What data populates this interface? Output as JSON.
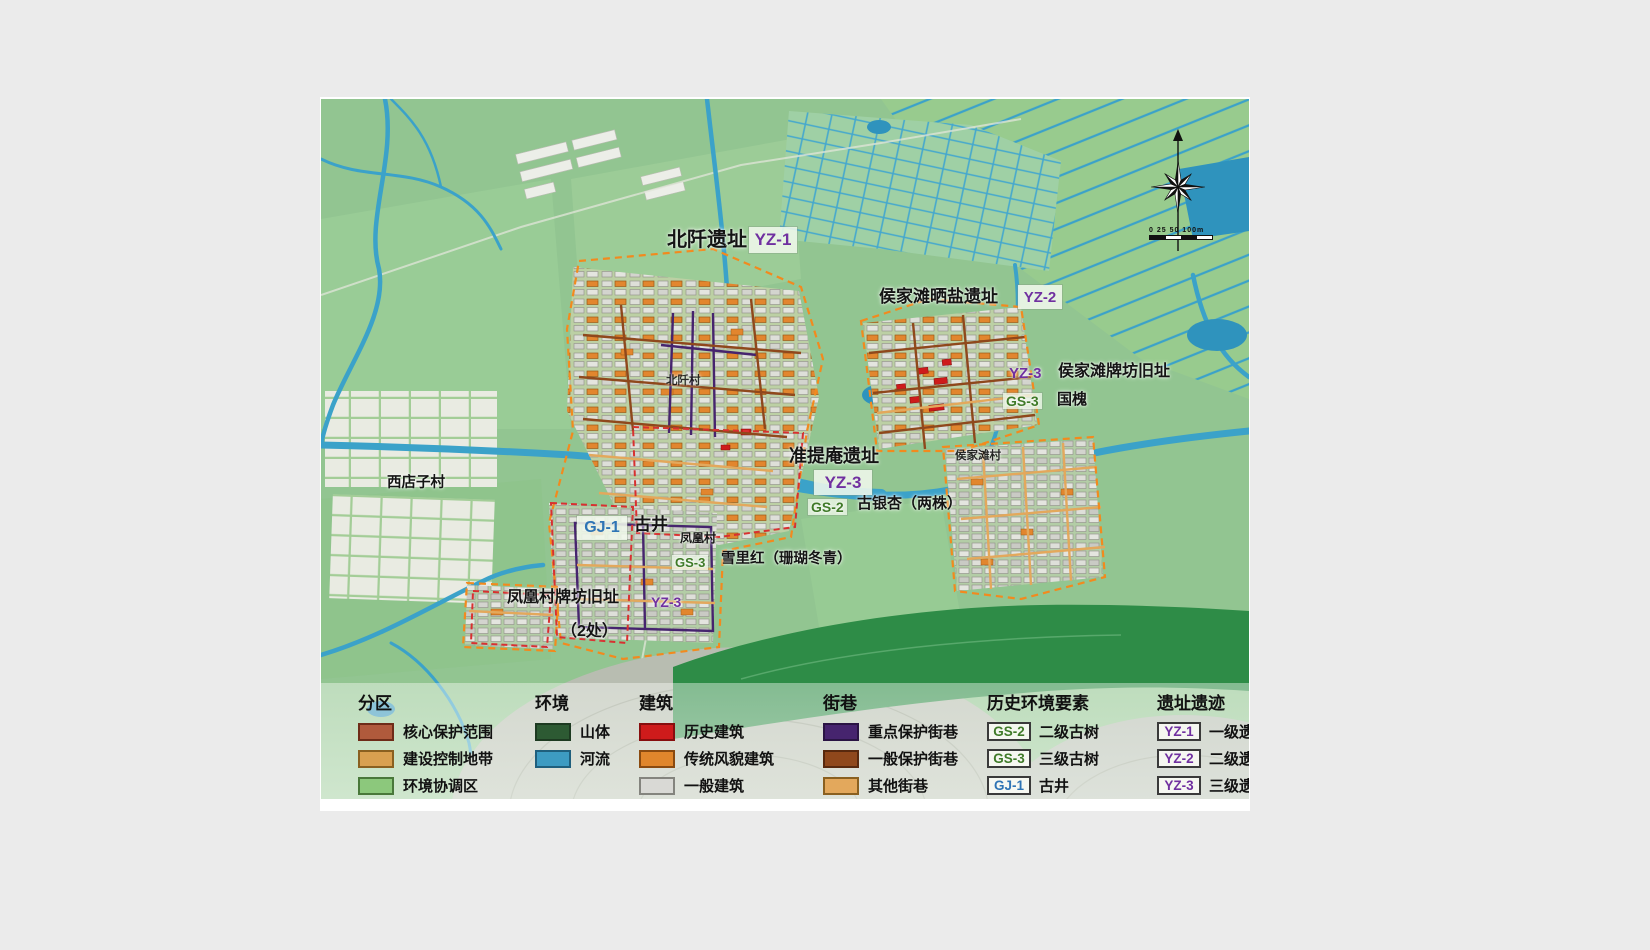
{
  "map_labels": {
    "beiqian_site": "北阡遗址",
    "beiqian_badge": "YZ-1",
    "houjiatan_salt_site": "侯家滩晒盐遗址",
    "houjiatan_salt_badge": "YZ-2",
    "houjiatan_paifang_badge": "YZ-3",
    "houjiatan_paifang_site": "侯家滩牌坊旧址",
    "houjiatan_tree_badge": "GS-3",
    "houjiatan_tree_label": "国槐",
    "zhuntian_site": "准提庵遗址",
    "zhuntian_badge": "YZ-3",
    "gingko_badge": "GS-2",
    "gingko_label": "古银杏（两株）",
    "well_badge": "GJ-1",
    "well_label": "古井",
    "xuelihong_badge": "GS-3",
    "xuelihong_label": "雪里红（珊瑚冬青）",
    "fenghuang_paifang_site": "凤凰村牌坊旧址",
    "fenghuang_paifang_badge": "YZ-3",
    "fenghuang_paifang_count": "（2处）",
    "village_xidianzi": "西店子村",
    "village_beiqian": "北阡村",
    "village_fenghuang": "凤凰村",
    "village_houjiatan": "侯家滩村",
    "scale_text": "0 25 50 100m"
  },
  "colors": {
    "yz_badge": "#7030a0",
    "gs_badge": "#3f7a28",
    "gj_badge": "#2e74b5",
    "river": "#3ba2c9",
    "base_green": "#92c591"
  },
  "legend": {
    "sections": [
      {
        "title": "分区",
        "items": [
          {
            "label": "核心保护范围",
            "swatch": "#b05a3c",
            "border": "#6e2c18"
          },
          {
            "label": "建设控制地带",
            "swatch": "#d9a050",
            "border": "#8a6020"
          },
          {
            "label": "环境协调区",
            "swatch": "#8cc87c",
            "border": "#49783a"
          }
        ]
      },
      {
        "title": "环境",
        "items": [
          {
            "label": "山体",
            "swatch": "#2d5a33",
            "border": "#1d3a21"
          },
          {
            "label": "河流",
            "swatch": "#3d9bc2",
            "border": "#1f5f7d"
          }
        ]
      },
      {
        "title": "建筑",
        "items": [
          {
            "label": "历史建筑",
            "swatch": "#ce1b1b",
            "border": "#870e0e"
          },
          {
            "label": "传统风貌建筑",
            "swatch": "#e0862c",
            "border": "#8a4a10"
          },
          {
            "label": "一般建筑",
            "swatch": "#d9d9d5",
            "border": "#84847e"
          }
        ]
      },
      {
        "title": "街巷",
        "items": [
          {
            "label": "重点保护街巷",
            "swatch": "#46246e",
            "border": "#2a1444"
          },
          {
            "label": "一般保护街巷",
            "swatch": "#8f481c",
            "border": "#58290e"
          },
          {
            "label": "其他街巷",
            "swatch": "#e3a85c",
            "border": "#8a6020"
          }
        ]
      },
      {
        "title": "历史环境要素",
        "items": [
          {
            "badge": "GS-2",
            "badge_color": "#3f7a28",
            "label": "二级古树"
          },
          {
            "badge": "GS-3",
            "badge_color": "#3f7a28",
            "label": "三级古树"
          },
          {
            "badge": "GJ-1",
            "badge_color": "#2e74b5",
            "label": "古井"
          }
        ]
      },
      {
        "title": "遗址遗迹",
        "items": [
          {
            "badge": "YZ-1",
            "badge_color": "#7030a0",
            "label": "一级遗址遗迹"
          },
          {
            "badge": "YZ-2",
            "badge_color": "#7030a0",
            "label": "二级遗址遗迹"
          },
          {
            "badge": "YZ-3",
            "badge_color": "#7030a0",
            "label": "三级遗址遗迹"
          }
        ]
      }
    ]
  }
}
